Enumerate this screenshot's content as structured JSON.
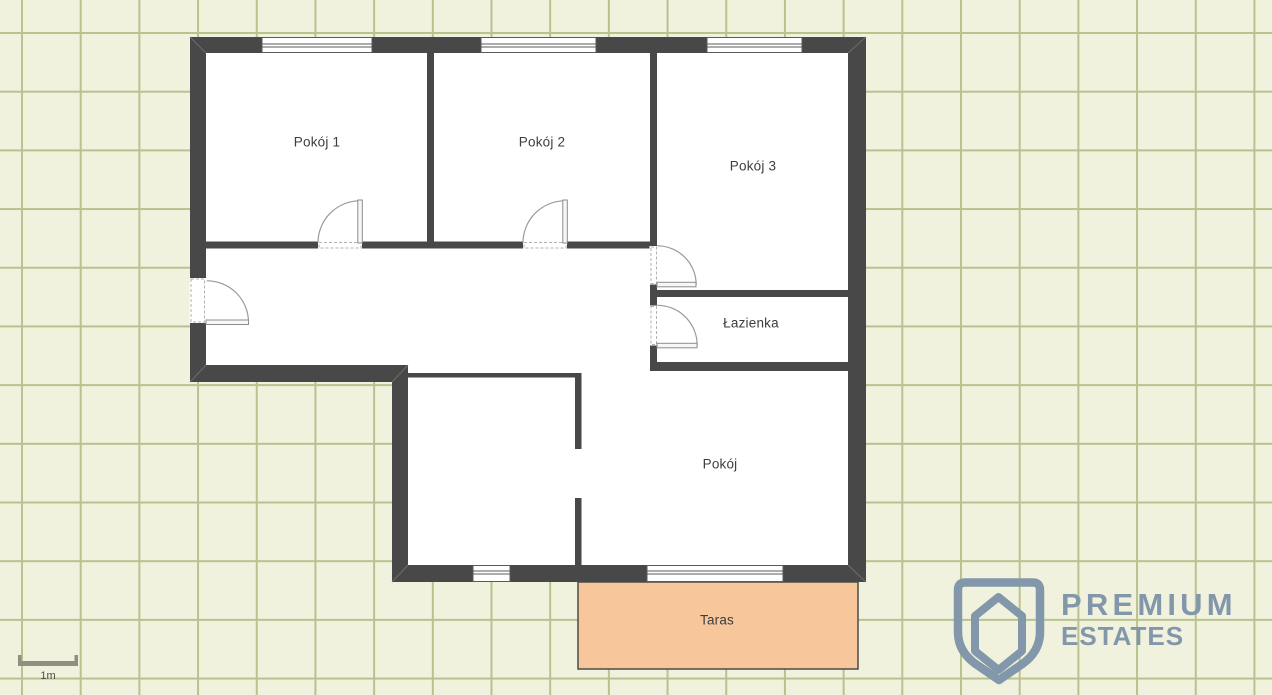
{
  "page": {
    "type": "real-estate floor plan"
  },
  "rooms": [
    {
      "id": "pokoj-1",
      "label": "Pokój 1"
    },
    {
      "id": "pokoj-2",
      "label": "Pokój 2"
    },
    {
      "id": "pokoj-3",
      "label": "Pokój 3"
    },
    {
      "id": "lazienka",
      "label": "Łazienka"
    },
    {
      "id": "pokoj",
      "label": "Pokój"
    },
    {
      "id": "taras",
      "label": "Taras"
    }
  ],
  "features": {
    "windows_top_wall": 3,
    "windows_bottom_wall": 2,
    "doors": [
      "entrance-door",
      "pokoj-1-door",
      "pokoj-2-door",
      "pokoj-3-door",
      "lazienka-door"
    ],
    "open_passage": "bottom-left-room-opening"
  },
  "scale": {
    "label": "1m"
  },
  "watermark": {
    "line1": "PREMIUM",
    "line2": "ESTATES",
    "icon": "shield-house-icon"
  },
  "colors": {
    "wall": "#484848",
    "floor": "#ffffff",
    "terrace_fill": "#f8c69b",
    "grid_bg": "#f0f2de",
    "grid_line": "#b9c18c",
    "logo_blue": "#8397ab",
    "label_text": "#3d3d3d",
    "scale_bar": "#8f9080"
  }
}
